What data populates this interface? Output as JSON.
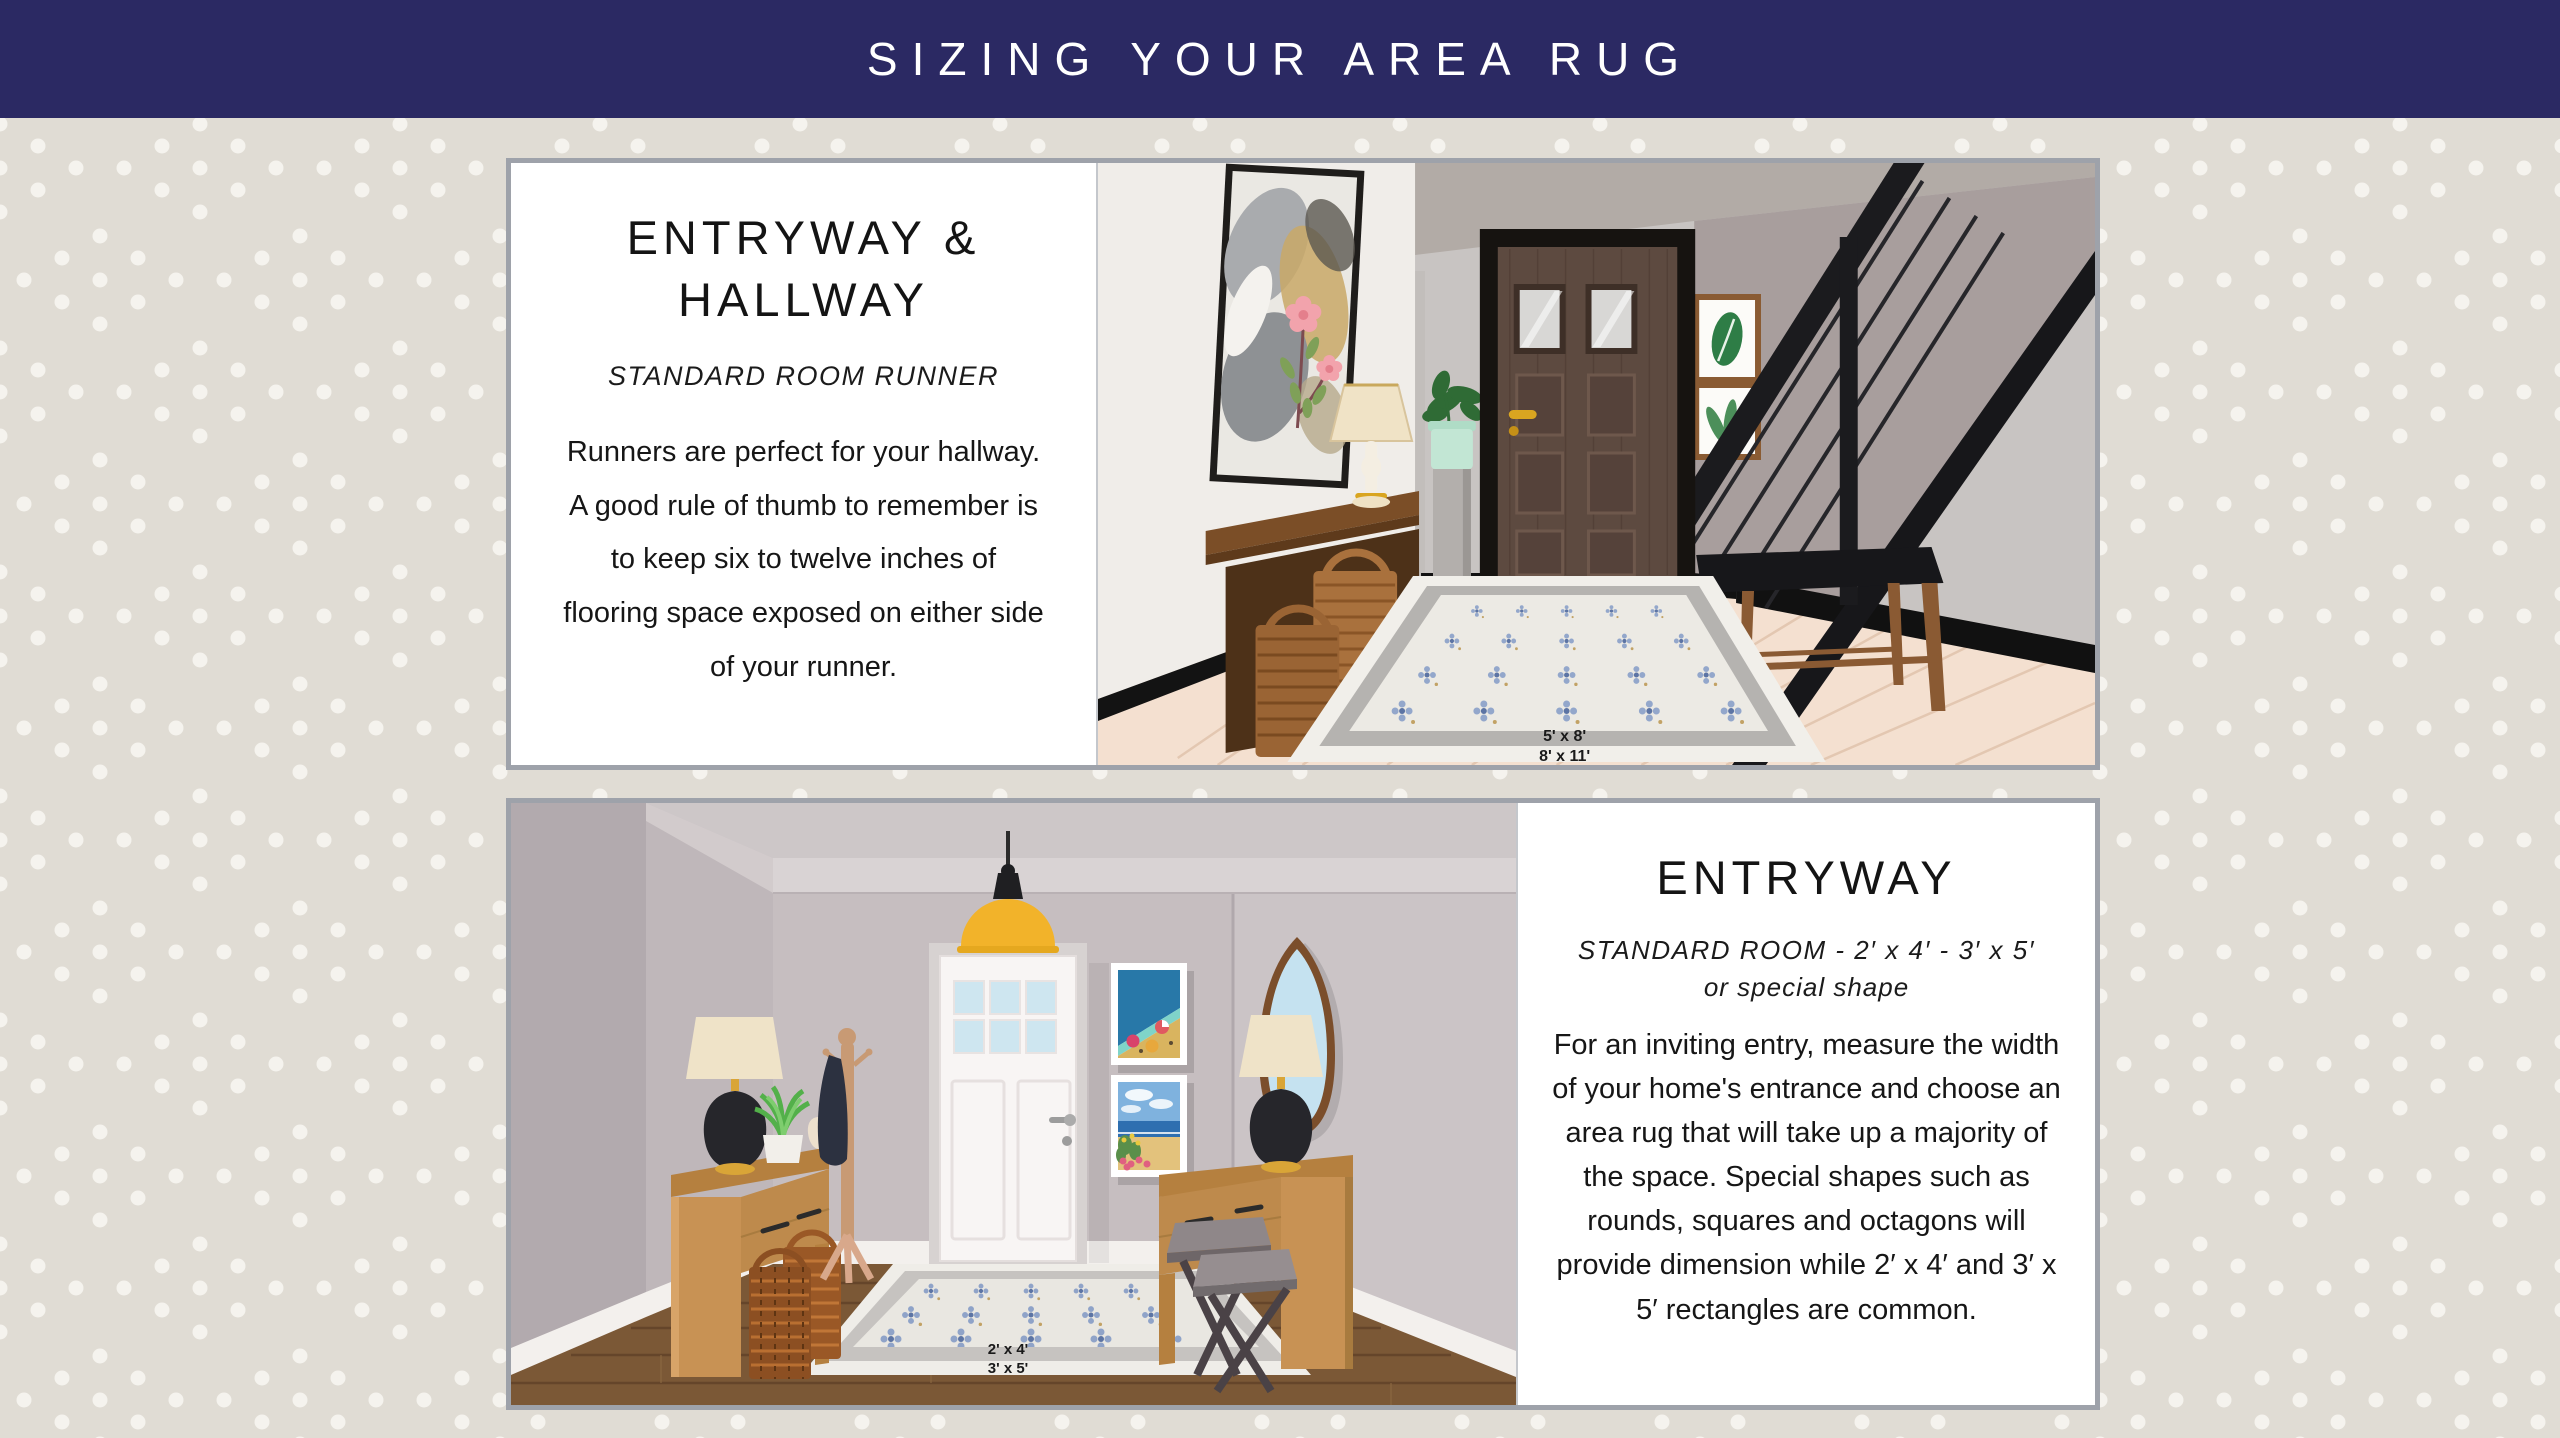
{
  "title": "SIZING YOUR AREA RUG",
  "theme": {
    "title_bar_bg": "#2B2963",
    "title_color": "#FFFFFF",
    "background": "#E0DCD4",
    "background_dot": "#F5F3EE",
    "panel_border": "#9EA2AA",
    "card_bg": "#FFFFFF",
    "text_color": "#161616"
  },
  "panel_top": {
    "heading": "ENTRYWAY & HALLWAY",
    "subtitle": "STANDARD ROOM RUNNER",
    "body": "Runners are perfect for your hallway. A good rule of thumb to remember is to keep six to twelve inches of flooring space exposed on either side of your runner.",
    "rug_labels": [
      "5' x 8'",
      "8' x 11'"
    ]
  },
  "panel_bottom": {
    "heading": "ENTRYWAY",
    "subtitle_line1": "STANDARD ROOM - 2′ x 4′ - 3′ x 5′",
    "subtitle_line2": "or special shape",
    "body": "For an inviting entry, measure the width of your home's entrance and choose an area rug that will take up a majority of the space. Special shapes such as rounds, squares and octagons will provide dimension while 2′ x 4′ and 3′ x 5′ rectangles are common.",
    "rug_labels": [
      "2' x 4'",
      "3' x 5'"
    ]
  }
}
